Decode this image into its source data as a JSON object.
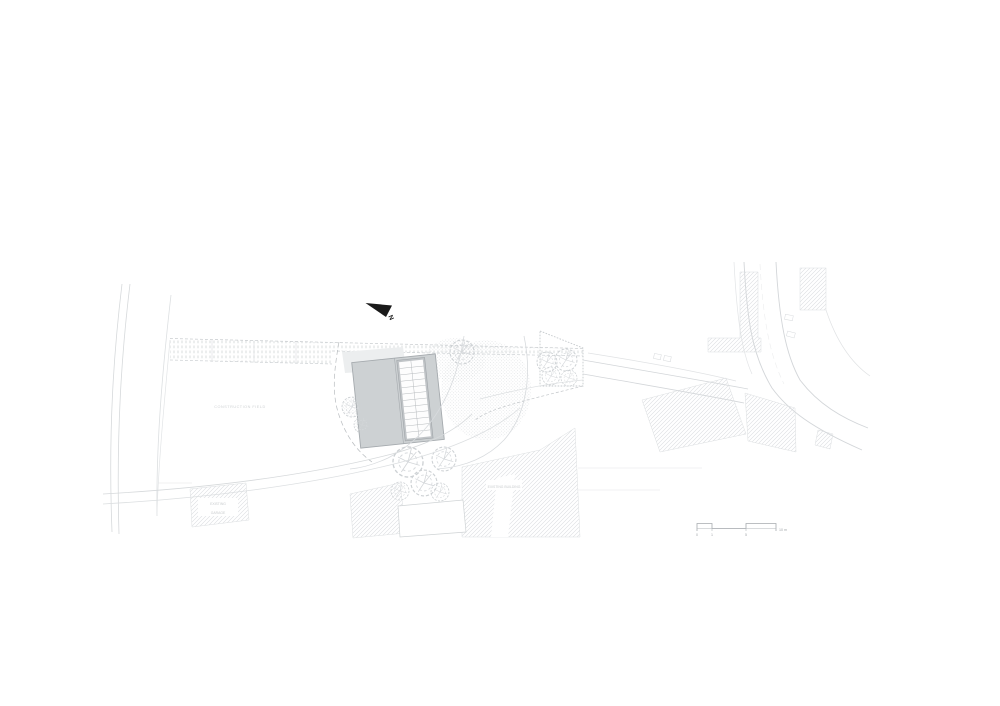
{
  "drawing": {
    "north_label": "N",
    "scale_bar": {
      "t0": "0",
      "t1": "1",
      "t2": "5",
      "t3": "10 m"
    },
    "labels": {
      "site_area": "CONSTRUCTION FIELD",
      "existing_building": "EXISTING BUILDING",
      "garage_1": "EXISTING",
      "garage_2": "GARAGE"
    },
    "colors": {
      "paper": "#ffffff",
      "line_light": "#d9dcde",
      "line_mid": "#c2c6c9",
      "building_fill": "#cdd1d3",
      "building_stroke": "#a5aaae",
      "hatch": "#d8dbde",
      "north_arrow": "#1a1a1a",
      "text_faint": "#c9ccce"
    }
  }
}
